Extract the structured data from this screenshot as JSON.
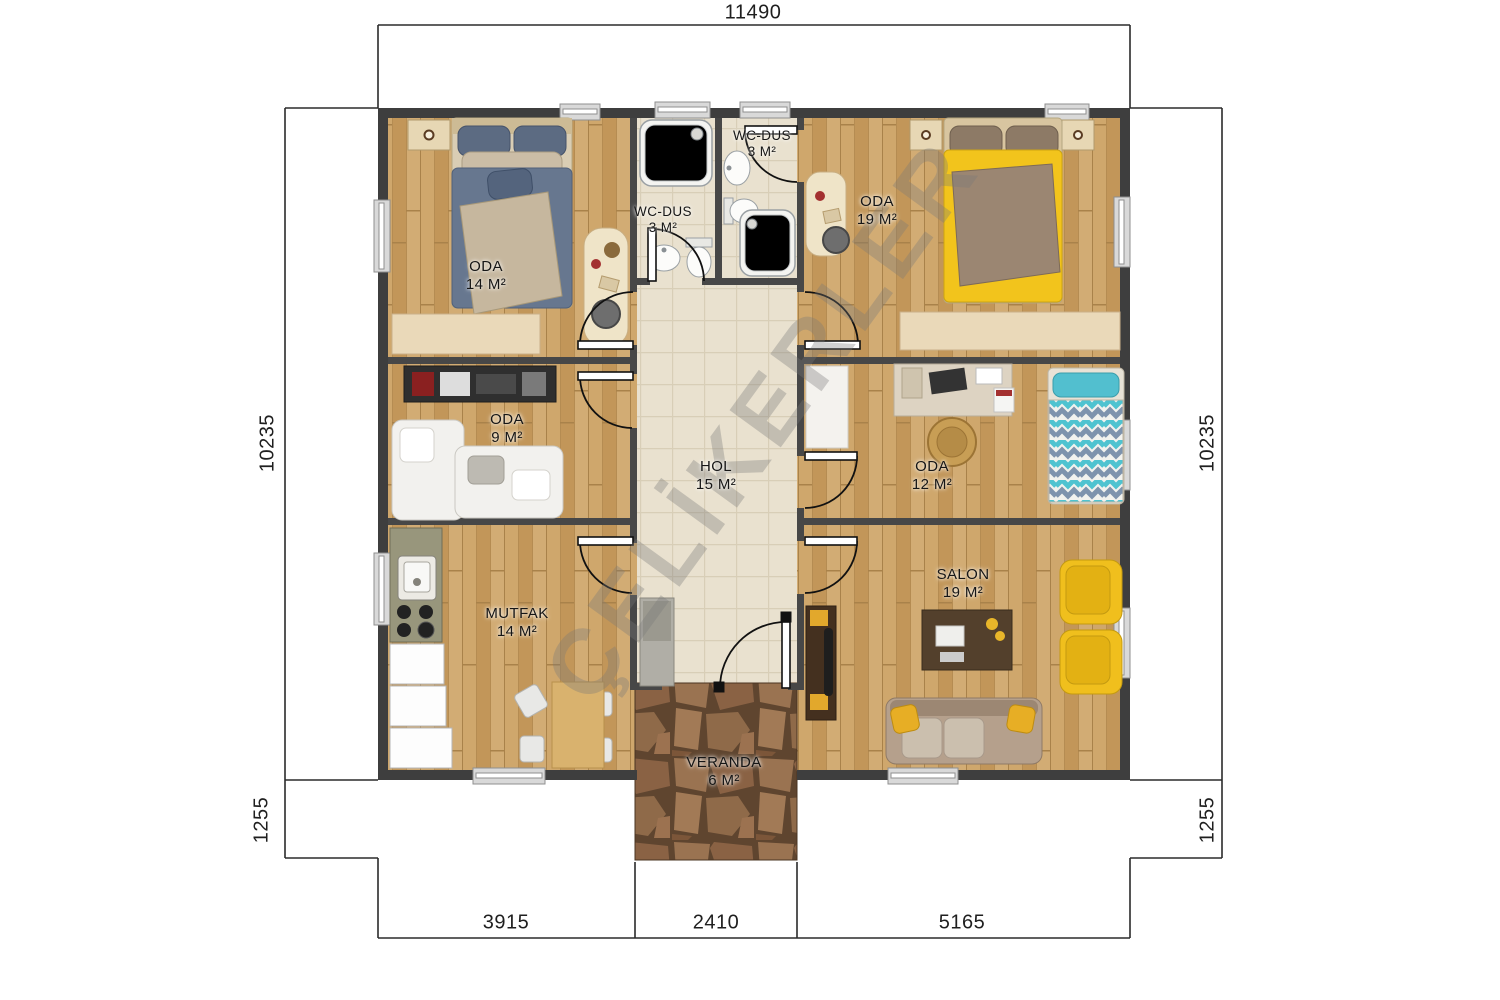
{
  "watermark": "ÇELİKERLER",
  "dims": {
    "top": "11490",
    "left_main": "10235",
    "left_lower": "1255",
    "right_main": "10235",
    "right_lower": "1255",
    "bottom_left": "3915",
    "bottom_center": "2410",
    "bottom_right": "5165"
  },
  "rooms": {
    "oda14": {
      "name": "ODA",
      "area": "14 M²"
    },
    "wc1": {
      "name": "WC-DUS",
      "area": "3 M²"
    },
    "wc2": {
      "name": "WC-DUS",
      "area": "3 M²"
    },
    "oda19": {
      "name": "ODA",
      "area": "19 M²"
    },
    "oda9": {
      "name": "ODA",
      "area": "9 M²"
    },
    "hol": {
      "name": "HOL",
      "area": "15 M²"
    },
    "oda12": {
      "name": "ODA",
      "area": "12 M²"
    },
    "mutfak": {
      "name": "MUTFAK",
      "area": "14 M²"
    },
    "salon": {
      "name": "SALON",
      "area": "19 M²"
    },
    "veranda": {
      "name": "VERANDA",
      "area": "6 M²"
    }
  },
  "colors": {
    "wall": "#3e3e3e",
    "wood_floor": "#c79e62",
    "tile_floor": "#e9e1cf",
    "stone_floor": "#8a6244",
    "bed_blue": "#67778f",
    "bed_yellow": "#f2c41c",
    "bed_teal": "#4fc3d0",
    "sofa_taupe": "#b5a08c",
    "armchair_yellow": "#f0bf1d"
  }
}
